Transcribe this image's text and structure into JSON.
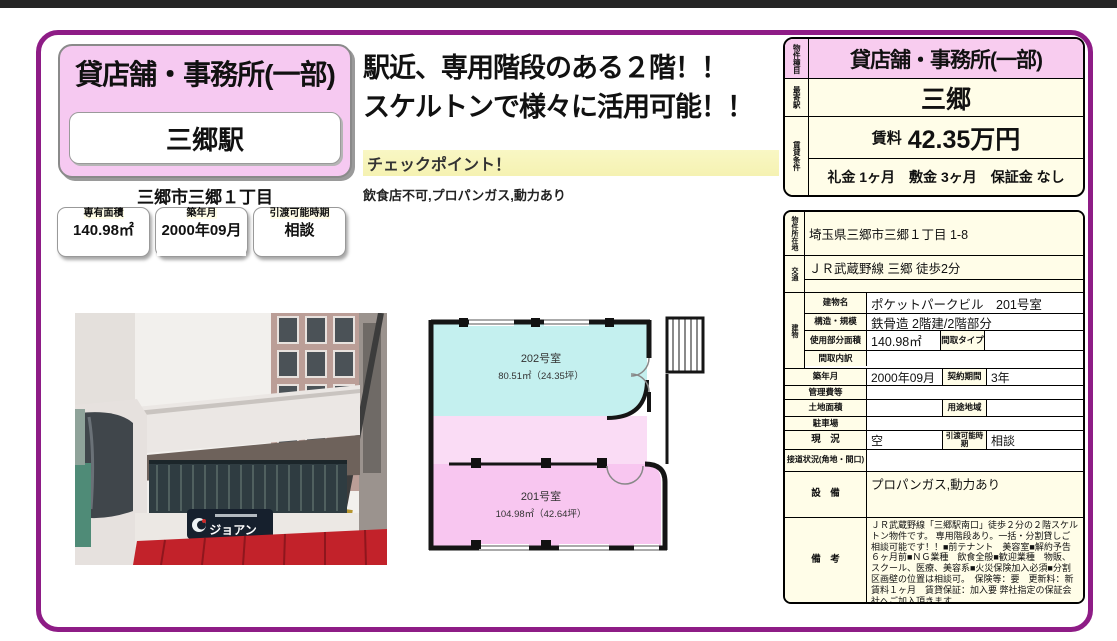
{
  "colors": {
    "frame_border": "#8e1c86",
    "header_pink": "#f8ccef",
    "panel_pink": "#f6c9f1",
    "cell_cream": "#fffde8",
    "checkpoint_yellow": "#f8f6c0",
    "awning_red": "#c2222a"
  },
  "left_panel": {
    "property_type": "貸店舗・事務所(一部)",
    "station": "三郷駅",
    "address_short": "三郷市三郷１丁目",
    "stat_boxes": [
      {
        "label": "専有面積",
        "value": "140.98㎡"
      },
      {
        "label": "築年月",
        "value": "2000年09月"
      },
      {
        "label": "引渡可能時期",
        "value": "相談"
      }
    ]
  },
  "headline": {
    "line1": "駅近、専用階段のある２階！！",
    "line2": "スケルトンで様々に活用可能！！",
    "checkpoint_label": "チェックポイント！",
    "checkpoint_text": "飲食店不可,プロパンガス,動力あり"
  },
  "photo": {
    "sign_text": "ジョアン"
  },
  "floorplan": {
    "rooms": [
      {
        "name": "202号室",
        "area": "80.51㎡（24.35坪）",
        "color": "#c4f0ef"
      },
      {
        "name": "201号室",
        "area": "104.98㎡（42.64坪）",
        "color": "#f8c6f0"
      }
    ]
  },
  "summary_table": {
    "property_type_label": "物件種目",
    "property_type": "貸店舗・事務所(一部)",
    "station_label": "最寄駅",
    "station": "三郷",
    "terms_label": "賃貸条件",
    "rent_label": "賃料",
    "rent": "42.35万円",
    "fees": "礼金 1ヶ月　敷金 3ヶ月　保証金 なし"
  },
  "detail_table": {
    "location_label": "物件所在地",
    "location": "埼玉県三郷市三郷１丁目 1-8",
    "access_label": "交通",
    "access": "ＪＲ武蔵野線 三郷 徒歩2分",
    "access2": "",
    "building_label": "建物",
    "building_name_label": "建物名",
    "building_name": "ポケットパークビル　201号室",
    "structure_label": "構造・規模",
    "structure": "鉄骨造 2階建/2階部分",
    "floor_area_label": "使用部分面積",
    "floor_area": "140.98㎡",
    "layout_type_label": "間取タイプ",
    "layout_type": "",
    "layout_detail_label": "間取内訳",
    "layout_detail": "",
    "built_label": "築年月",
    "built": "2000年09月",
    "contract_label": "契約期間",
    "contract": "3年",
    "mgmt_fee_label": "管理費等",
    "mgmt_fee": "",
    "land_area_label": "土地面積",
    "land_area": "",
    "zoning_label": "用途地域",
    "zoning": "",
    "parking_label": "駐車場",
    "parking": "",
    "status_label": "現　況",
    "status": "空",
    "handover_label": "引渡可能時期",
    "handover": "相談",
    "road_label": "接道状況(角地・間口)",
    "road": "",
    "equipment_label": "設　備",
    "equipment": "プロパンガス,動力あり",
    "notes_label": "備　考",
    "notes": "ＪＲ武蔵野線「三郷駅南口」徒歩２分の２階スケルトン物件です。 専用階段あり。一括・分割貸しご相談可能です！！■前テナント　美容室■解約予告　６ヶ月前■ＮＧ業種　飲食全般■歓迎業種　物販、スクール、医療、美容系■火災保険加入必須■分割区画壁の位置は相談可。　保険等：要　更新料：新賃料１ヶ月　賃貸保証：加入要 弊社指定の保証会社へご加入頂きます。"
  }
}
